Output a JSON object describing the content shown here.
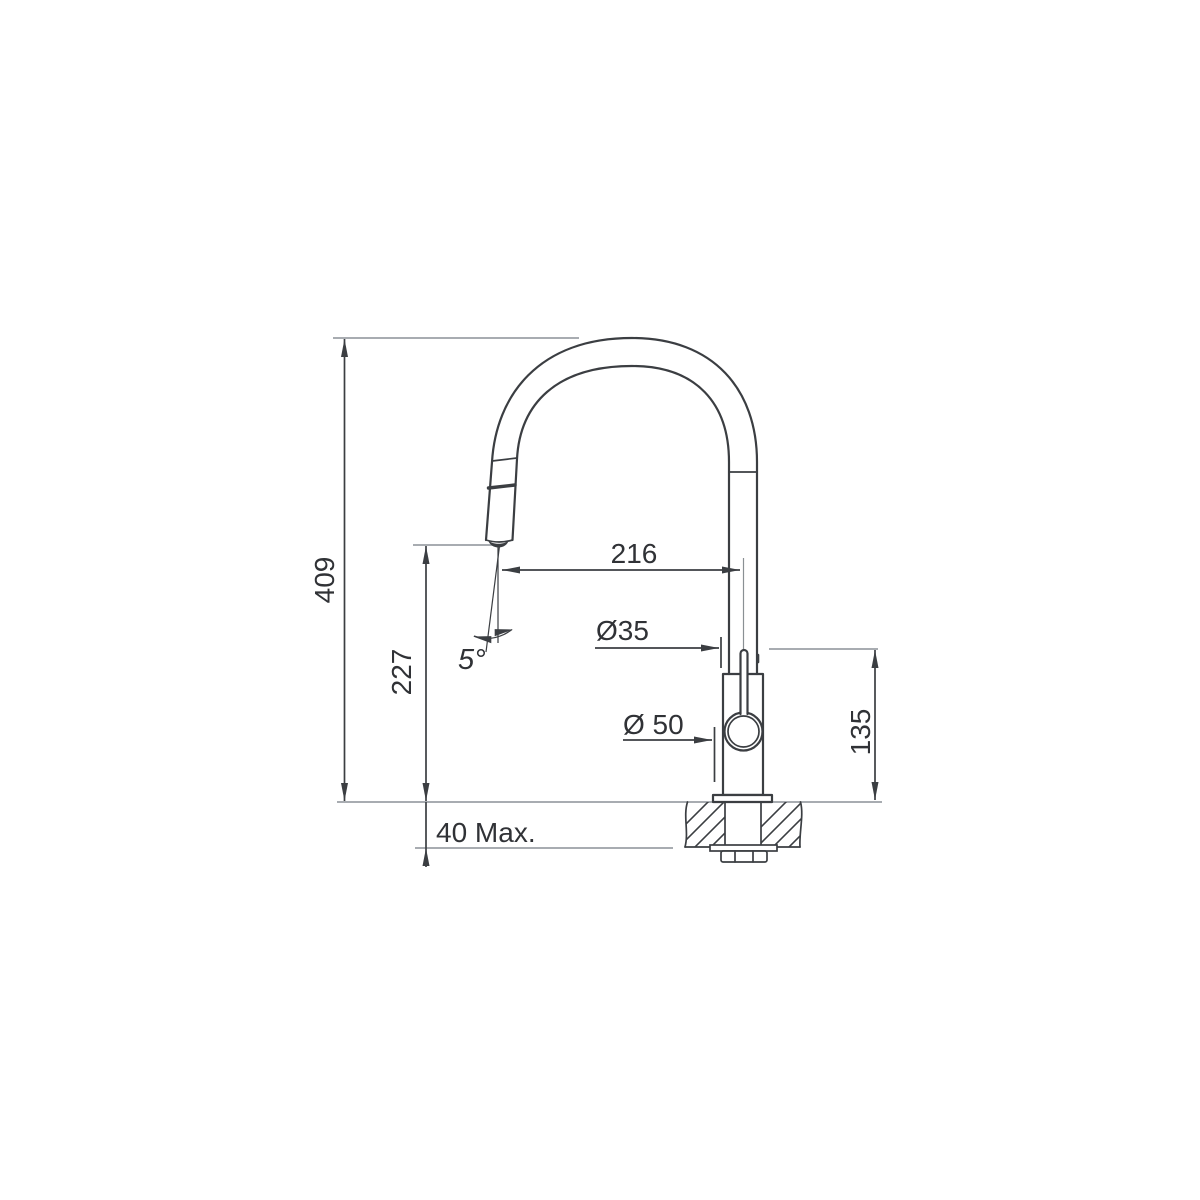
{
  "colors": {
    "background": "#ffffff",
    "object_line": "#3b3e42",
    "dimension_line": "#3b3e42",
    "extension_line": "#9ba1a6",
    "text_color": "#303236"
  },
  "dimensions": {
    "overall_height": {
      "label": "409"
    },
    "outlet_height": {
      "label": "227"
    },
    "spout_reach": {
      "label": "216"
    },
    "body_diameter": {
      "label": "Ø35"
    },
    "base_diameter": {
      "label": "Ø 50"
    },
    "lever_height_above_deck": {
      "label": "135"
    },
    "deck_thickness_max": {
      "label": "40 Max."
    },
    "spray_angle": {
      "label": "5°"
    }
  }
}
